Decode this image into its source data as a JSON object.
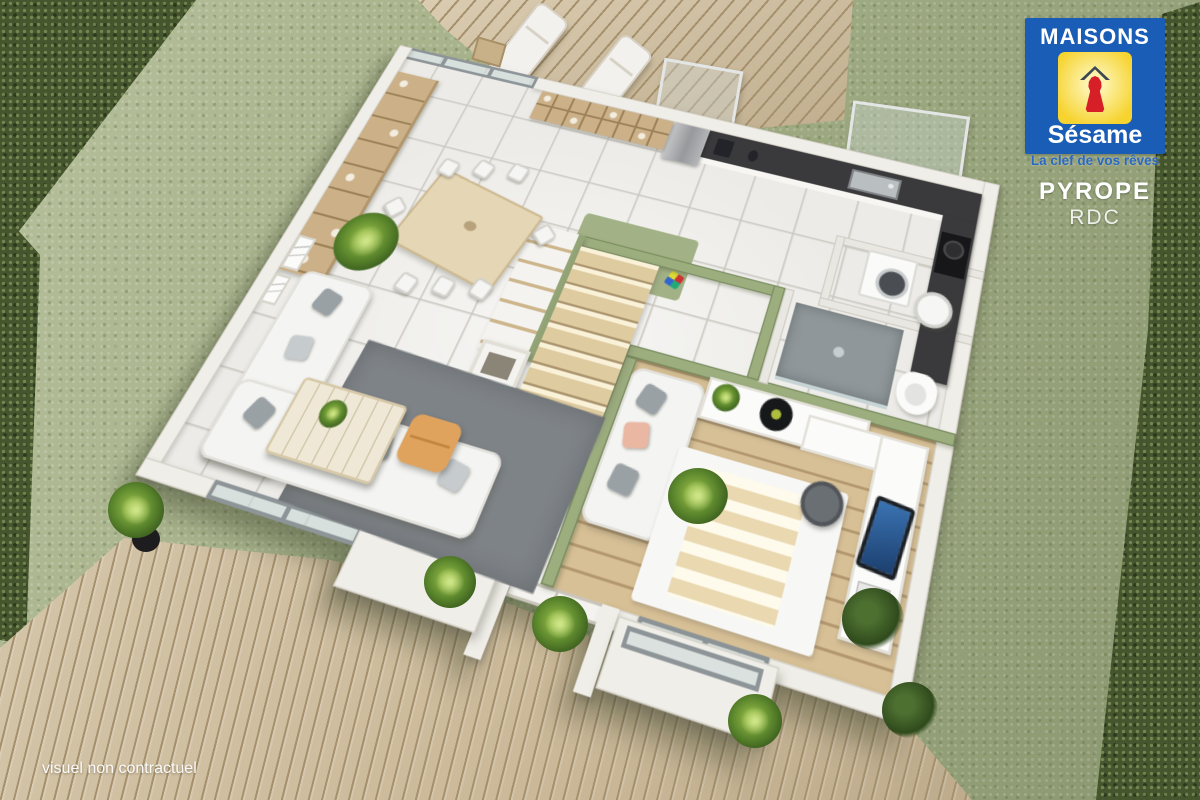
{
  "branding": {
    "name": "MAISONS",
    "sub": "Sésame",
    "tagline": "La clef de vos rêves",
    "logo_icon": "keyhole-house-icon"
  },
  "plan_info": {
    "model": "PYROPE",
    "floor": "RDC"
  },
  "disclaimer": "visuel non contractuel",
  "colors": {
    "brand-blue": "#1a5db6",
    "brand-yellow": "#f6d32e",
    "brand-yellow-light": "#fdf4b2",
    "brand-red": "#d71f27",
    "tagline-blue": "#2a69c2",
    "grass": "#a1ad84",
    "hedge": "#45552e",
    "deck-wood": "#cbb999",
    "deck-line": "#a6916e",
    "tile": "#ecebe7",
    "wall": "#f0eee8",
    "olive-wall": "#9cad7e",
    "wood-floor": "#d8c096",
    "counter-dark": "#3a3a3c",
    "rug-gray": "#7e8387",
    "sofa-white": "#f4f4f2",
    "furn-wood": "#cbb088",
    "pouf-orange": "#dfa35e",
    "stairs-wood": "#decb9f"
  }
}
